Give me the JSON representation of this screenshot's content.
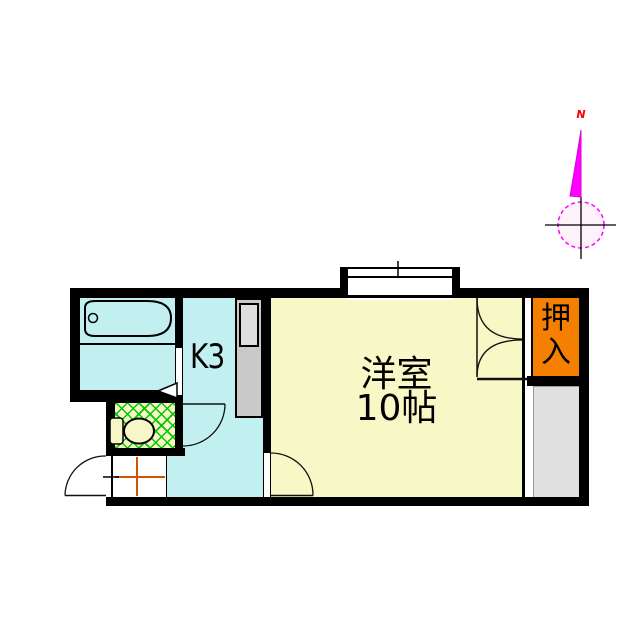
{
  "rooms": {
    "kitchen": {
      "label": "K3",
      "floor_color": "#c2f0f0"
    },
    "bathroom": {
      "floor_color": "#c2f0f0"
    },
    "main_room": {
      "label_line1": "洋室",
      "label_line2": "10帖",
      "floor_color": "#f8f7c6"
    },
    "closet": {
      "label": "押入",
      "color": "#f57f00"
    },
    "storage": {
      "color": "#e0e0e0"
    },
    "toilet": {
      "floor_color": "#f6f6c6",
      "hatch_color": "#00c800"
    },
    "entrance": {
      "tile_line_color": "#cc5500"
    }
  },
  "compass": {
    "label": "N",
    "needle_color": "#ff00ff",
    "label_color": "#ff0000"
  },
  "wall_color": "#000000"
}
